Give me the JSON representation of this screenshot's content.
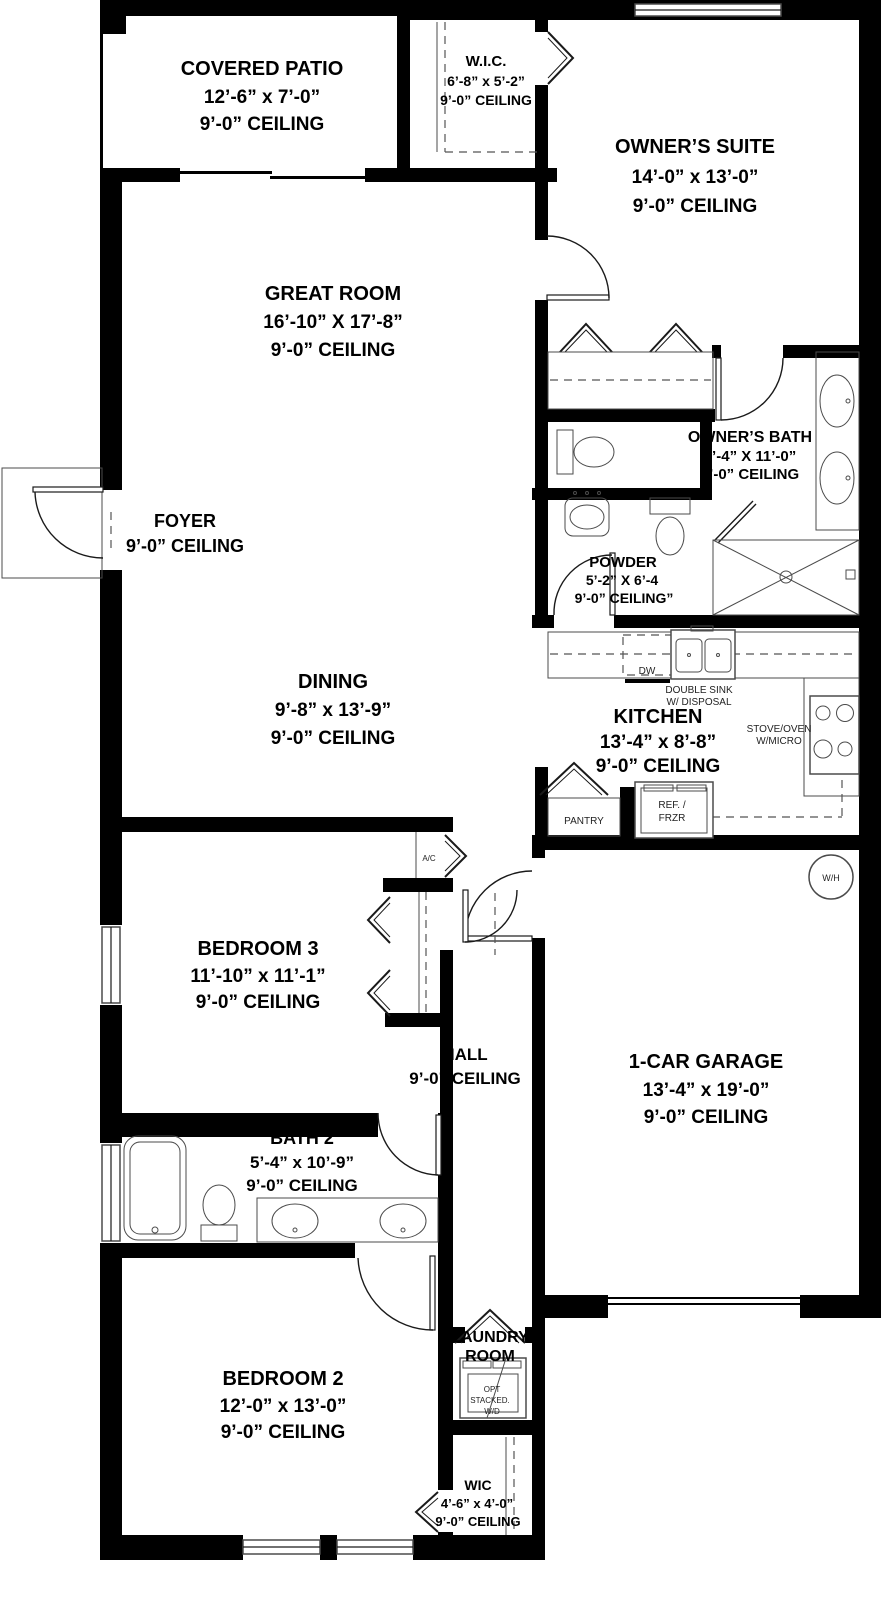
{
  "colors": {
    "walls": "#000000",
    "background": "#ffffff",
    "fixture_lines": "#4b4b4b"
  },
  "rooms": {
    "covered_patio": {
      "name": "COVERED PATIO",
      "dims": "12’-6” x 7’-0”",
      "ceiling": "9’-0” CEILING"
    },
    "wic_owners": {
      "name": "W.I.C.",
      "dims": "6’-8” x 5’-2”",
      "ceiling": "9’-0” CEILING"
    },
    "owners_suite": {
      "name": "OWNER’S SUITE",
      "dims": "14’-0” x 13’-0”",
      "ceiling": "9’-0” CEILING"
    },
    "great_room": {
      "name": "GREAT ROOM",
      "dims": "16’-10” X 17’-8”",
      "ceiling": "9’-0” CEILING"
    },
    "foyer": {
      "name": "FOYER",
      "ceiling": "9’-0” CEILING"
    },
    "owners_bath": {
      "name": "OWNER’S BATH",
      "dims": "6’-4” X 11’-0”",
      "ceiling": "9’-0” CEILING"
    },
    "powder": {
      "name": "POWDER",
      "dims": "5’-2” X 6’-4",
      "ceiling": "9’-0” CEILING”"
    },
    "dining": {
      "name": "DINING",
      "dims": "9’-8” x 13’-9”",
      "ceiling": "9’-0” CEILING"
    },
    "kitchen": {
      "name": "KITCHEN",
      "dims": "13’-4” x 8’-8”",
      "ceiling": "9’-0” CEILING"
    },
    "bedroom_3": {
      "name": "BEDROOM 3",
      "dims": "11’-10” x 11’-1”",
      "ceiling": "9’-0” CEILING"
    },
    "hall": {
      "name": "HALL",
      "ceiling": "9’-0” CEILING"
    },
    "garage": {
      "name": "1-CAR GARAGE",
      "dims": "13’-4” x 19’-0”",
      "ceiling": "9’-0” CEILING"
    },
    "bath_2": {
      "name": "BATH 2",
      "dims": "5’-4” x 10’-9”",
      "ceiling": "9’-0” CEILING"
    },
    "bedroom_2": {
      "name": "BEDROOM 2",
      "dims": "12’-0” x 13’-0”",
      "ceiling": "9’-0” CEILING"
    },
    "laundry": {
      "line1": "LAUNDRY",
      "line2": "ROOM"
    },
    "wic_2": {
      "name": "WIC",
      "dims": "4’-6” x 4’-0”",
      "ceiling": "9’-0” CEILING"
    }
  },
  "labels": {
    "dw": "DW",
    "double_sink_line1": "DOUBLE SINK",
    "double_sink_line2": "W/ DISPOSAL",
    "stove_line1": "STOVE/OVEN",
    "stove_line2": "W/MICRO",
    "fridge_line1": "REF. /",
    "fridge_line2": "FRZR",
    "pantry": "PANTRY",
    "ac": "A/C",
    "water_heater": "W/H",
    "washer_dryer_line1": "OPT",
    "washer_dryer_line2": "STACKED.",
    "washer_dryer_line3": "W/D"
  }
}
